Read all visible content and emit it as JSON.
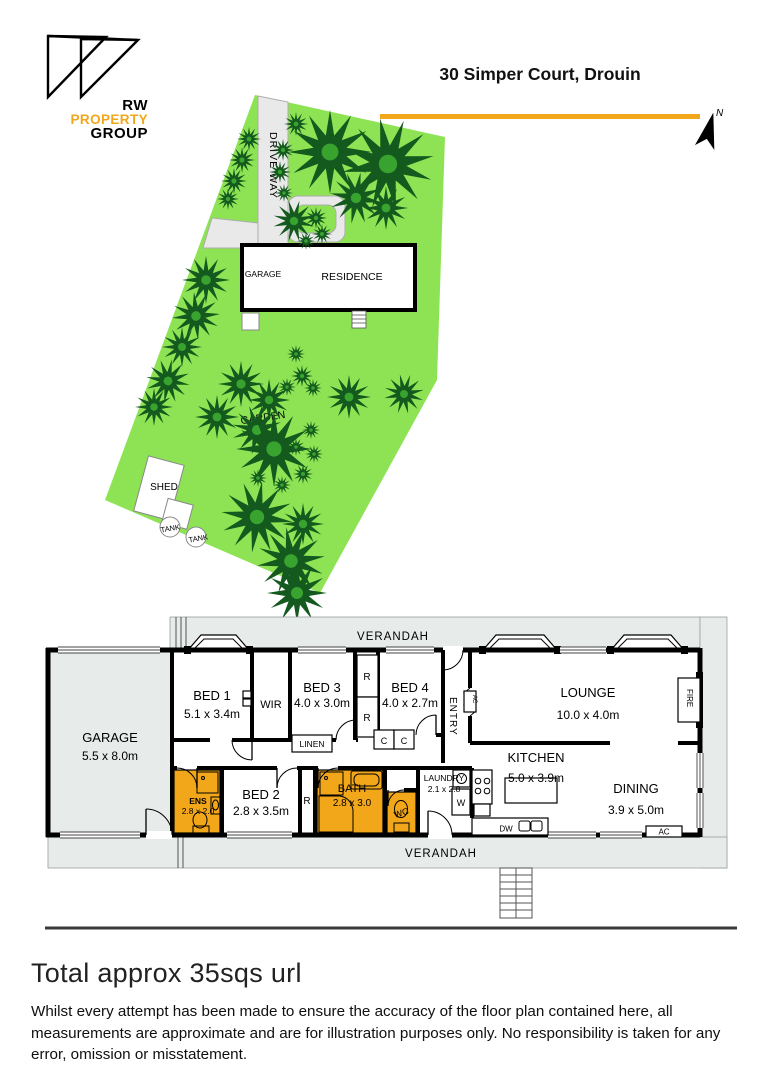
{
  "header": {
    "logo": {
      "line1": "RW",
      "line2": "PROPERTY",
      "line3": "GROUP"
    },
    "title": "30 Simper Court, Drouin",
    "north_label": "N"
  },
  "site_plan": {
    "driveway": "DRIVE WAY",
    "garage": "GARAGE",
    "residence": "RESIDENCE",
    "garden": "GARDEN",
    "shed": "SHED",
    "tank1": "TANK",
    "tank2": "TANK"
  },
  "floor_plan": {
    "verandah_top": "VERANDAH",
    "verandah_bottom": "VERANDAH",
    "rooms": {
      "garage": {
        "name": "GARAGE",
        "dims": "5.5 x 8.0m"
      },
      "bed1": {
        "name": "BED 1",
        "dims": "5.1 x 3.4m"
      },
      "wir": {
        "name": "WIR"
      },
      "bed3": {
        "name": "BED 3",
        "dims": "4.0 x 3.0m"
      },
      "bed4": {
        "name": "BED 4",
        "dims": "4.0 x 2.7m"
      },
      "lounge": {
        "name": "LOUNGE",
        "dims": "10.0 x 4.0m"
      },
      "entry": {
        "name": "ENTRY"
      },
      "kitchen": {
        "name": "KITCHEN",
        "dims": "5.0 x 3.9m"
      },
      "dining": {
        "name": "DINING",
        "dims": "3.9 x 5.0m"
      },
      "bed2": {
        "name": "BED 2",
        "dims": "2.8 x 3.5m"
      },
      "ens": {
        "name": "ENS",
        "dims": "2.8 x 2.0"
      },
      "bath": {
        "name": "BATH",
        "dims": "2.8 x 3.0"
      },
      "laundry": {
        "name": "LAUNDRY",
        "dims": "2.1 x 2.8"
      },
      "wc": {
        "name": "WC"
      },
      "linen": {
        "name": "LINEN"
      },
      "fire": {
        "name": "FIRE"
      }
    },
    "labels": {
      "robe": "R",
      "cupboard": "C",
      "washer": "W",
      "dishwasher": "DW",
      "ac": "AC"
    }
  },
  "footer": {
    "total": "Total approx 35sqs url",
    "disclaimer": "Whilst every attempt has been made to ensure the accuracy of the floor plan contained here, all measurements are approximate and are for illustration purposes only. No responsibility is taken for any error, omission or misstatement."
  },
  "colors": {
    "accent_orange": "#F2A71B",
    "lot_green": "#8EE354",
    "tree_green": "#14591D",
    "wet_area_orange": "#F2A71B",
    "verandah_gray": "#E7EBEA"
  }
}
